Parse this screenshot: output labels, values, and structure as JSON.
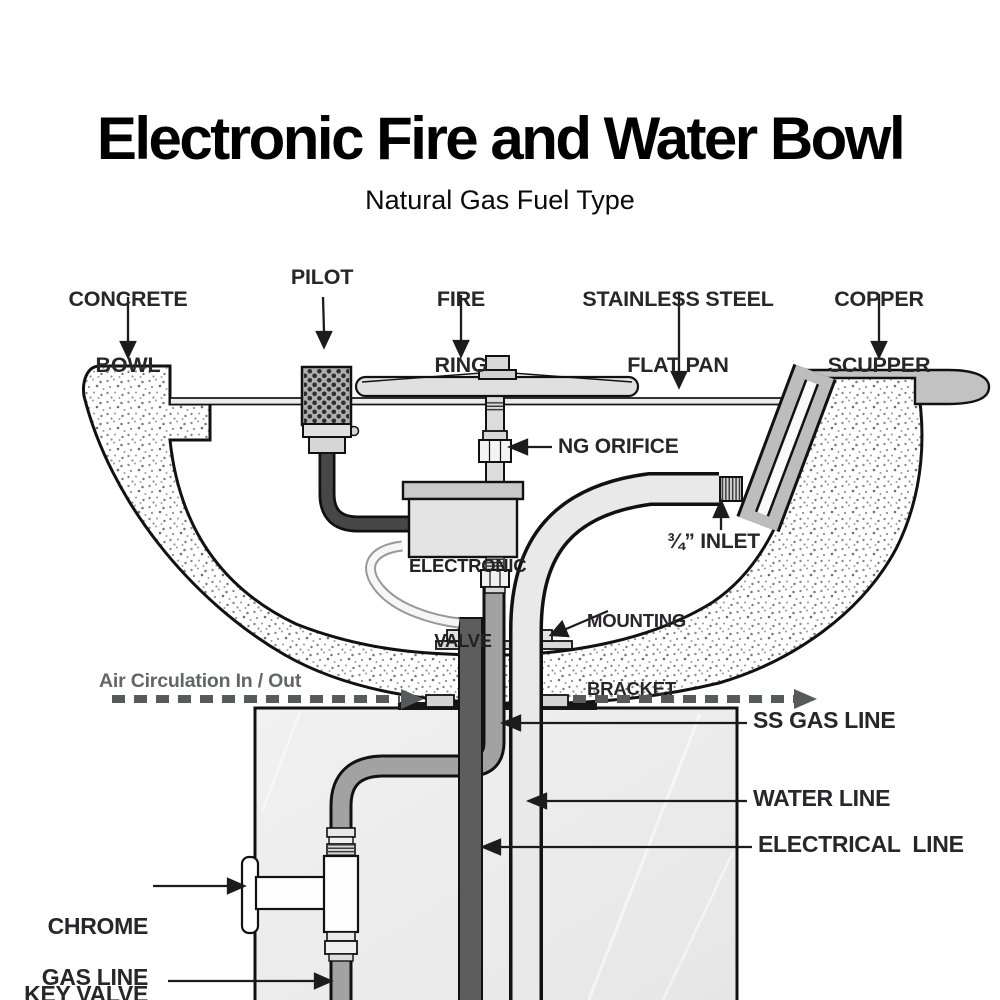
{
  "header": {
    "title": "Electronic Fire and Water Bowl",
    "subtitle": "Natural Gas Fuel Type"
  },
  "labels": {
    "concrete_bowl": {
      "line1": "CONCRETE",
      "line2": "BOWL"
    },
    "pilot": "PILOT",
    "fire_ring": {
      "line1": "FIRE",
      "line2": "RING"
    },
    "flat_pan": {
      "line1": "STAINLESS STEEL",
      "line2": "FLAT PAN"
    },
    "copper_scupper": {
      "line1": "COPPER",
      "line2": "SCUPPER"
    },
    "ng_orifice": "NG ORIFICE",
    "inlet": "¾” INLET",
    "mounting_bracket": {
      "line1": "MOUNTING",
      "line2": "BRACKET"
    },
    "air_circulation": "Air Circulation In / Out",
    "ss_gas_line": "SS GAS LINE",
    "water_line": "WATER LINE",
    "electrical_line": "ELECTRICAL  LINE",
    "chrome_key_valve": {
      "line1": "CHROME",
      "line2": "KEY VALVE"
    },
    "gas_line": "GAS LINE",
    "electronic_valve": {
      "line1": "ELECTRONIC",
      "line2": "VALVE"
    }
  },
  "colors": {
    "outline": "#111111",
    "text": "#29262a",
    "air_circulation_gray": "#58595b",
    "concrete_dot": "#8c8c8c",
    "light_gray": "#e4e4e4",
    "mid_gray": "#a5a5a5",
    "scupper_gray": "#bdbdbd",
    "dark_gray": "#5d5d5d",
    "pilot_pipe": "#474747",
    "pedestal": "#ededed"
  }
}
